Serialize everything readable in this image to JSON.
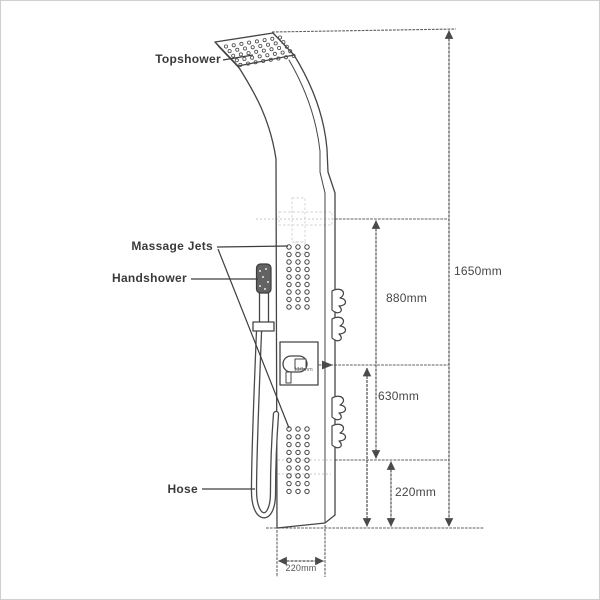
{
  "diagram": {
    "title": "Shower panel dimension drawing",
    "callouts": {
      "topshower": "Topshower",
      "massage_jets": "Massage Jets",
      "handshower": "Handshower",
      "hose": "Hose"
    },
    "dimensions": {
      "overall_height": "1650mm",
      "upper_section": "880mm",
      "middle_section": "630mm",
      "lower_section": "220mm",
      "panel_width": "220mm",
      "mixer_detail": "110mm"
    }
  }
}
